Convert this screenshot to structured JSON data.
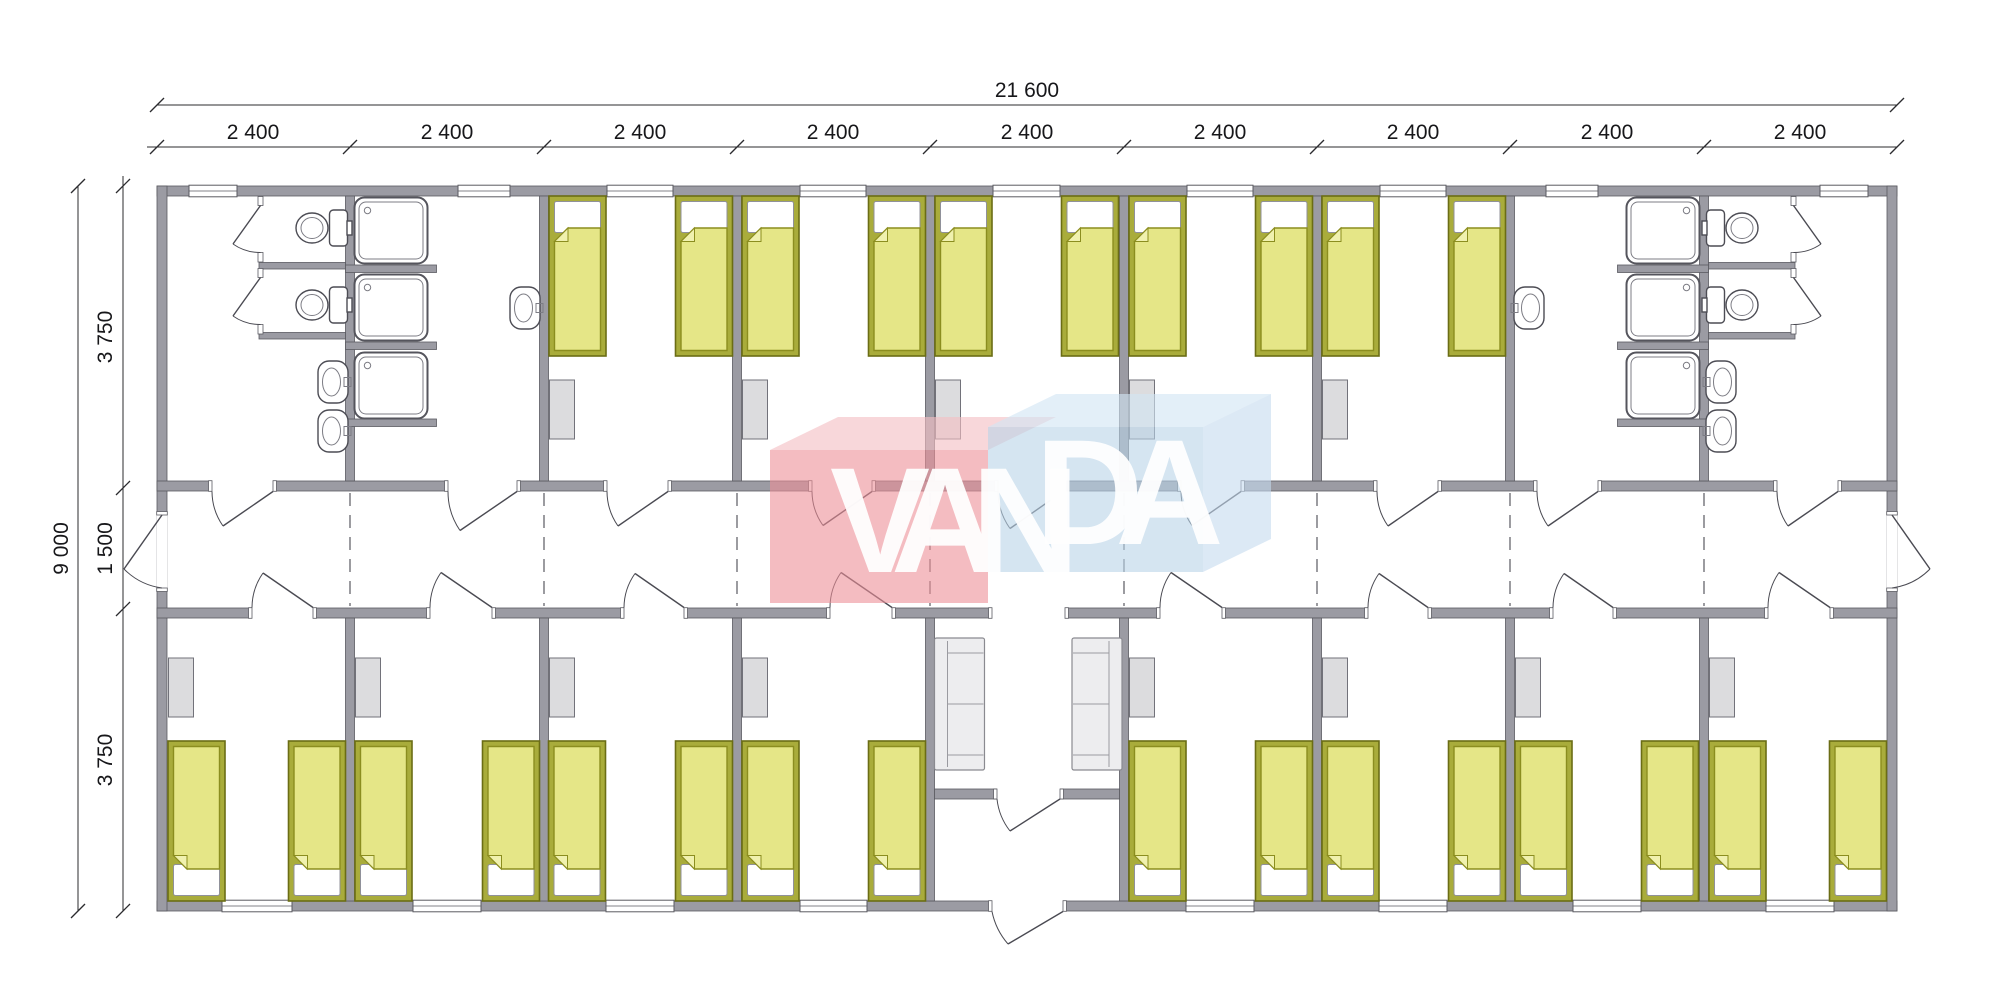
{
  "drawing": {
    "brand": {
      "name": "VANDA",
      "part1": "VAN",
      "part2": "DA"
    },
    "dimensions": {
      "total_width": "21 600",
      "module_widths": [
        "2 400",
        "2 400",
        "2 400",
        "2 400",
        "2 400",
        "2 400",
        "2 400",
        "2 400",
        "2 400"
      ],
      "total_height": "9 000",
      "left_segments": [
        "3 750",
        "1 500",
        "3 750"
      ]
    },
    "colors": {
      "wall_grey": "#9b9ba3",
      "bed_frame_olive": "#a9ac3b",
      "bed_blanket_yellow": "#e5e687",
      "furniture_grey": "#dcdcde",
      "logo_red": "#ec8f98",
      "logo_blue": "#b9d3e8"
    },
    "plan": {
      "building_type": "modular dormitory floor plan",
      "modules": 9,
      "corridor": "central corridor with module lines shown dashed",
      "top_row_rooms": [
        {
          "type": "wc-room",
          "toilets": 2,
          "wash_basins": 2,
          "windows": 1
        },
        {
          "type": "shower-room",
          "showers": 3,
          "wash_basins": 1,
          "windows": 1
        },
        {
          "type": "bedroom",
          "beds": 2,
          "wardrobes": 1,
          "windows": 1
        },
        {
          "type": "bedroom",
          "beds": 2,
          "wardrobes": 1,
          "windows": 1
        },
        {
          "type": "bedroom",
          "beds": 2,
          "wardrobes": 1,
          "windows": 1
        },
        {
          "type": "bedroom",
          "beds": 2,
          "wardrobes": 1,
          "windows": 1
        },
        {
          "type": "bedroom",
          "beds": 2,
          "wardrobes": 1,
          "windows": 1
        },
        {
          "type": "shower-room",
          "showers": 3,
          "wash_basins": 1,
          "windows": 1
        },
        {
          "type": "wc-room",
          "toilets": 2,
          "wash_basins": 2,
          "windows": 1
        }
      ],
      "bottom_row_rooms": [
        {
          "type": "bedroom",
          "beds": 2,
          "wardrobes": 1,
          "windows": 1
        },
        {
          "type": "bedroom",
          "beds": 2,
          "wardrobes": 1,
          "windows": 1
        },
        {
          "type": "bedroom",
          "beds": 2,
          "wardrobes": 1,
          "windows": 1
        },
        {
          "type": "bedroom",
          "beds": 2,
          "wardrobes": 1,
          "windows": 1
        },
        {
          "type": "entrance-lobby",
          "sofas": 2,
          "entrance_doors": 1
        },
        {
          "type": "bedroom",
          "beds": 2,
          "wardrobes": 1,
          "windows": 1
        },
        {
          "type": "bedroom",
          "beds": 2,
          "wardrobes": 1,
          "windows": 1
        },
        {
          "type": "bedroom",
          "beds": 2,
          "wardrobes": 1,
          "windows": 1
        },
        {
          "type": "bedroom",
          "beds": 2,
          "wardrobes": 1,
          "windows": 1
        }
      ]
    }
  }
}
